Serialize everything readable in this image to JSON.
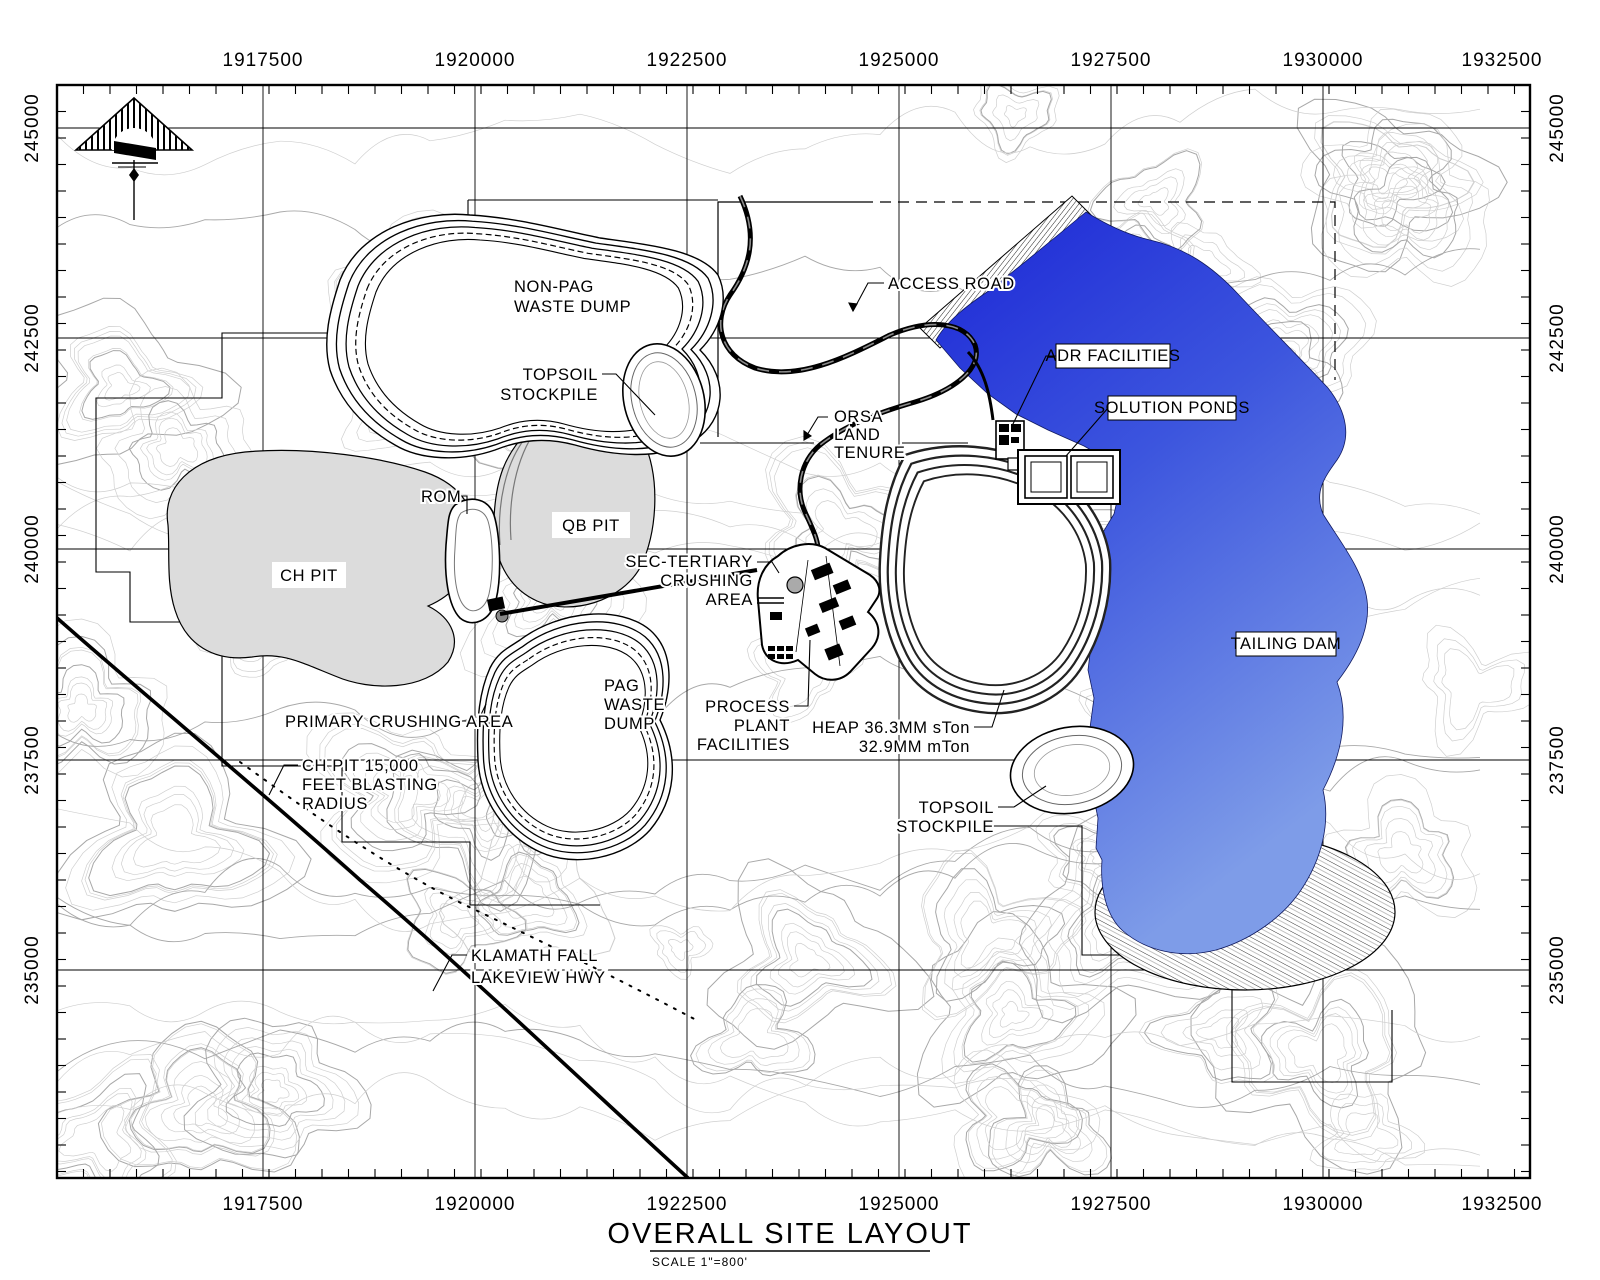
{
  "map": {
    "axis": {
      "x_labels": [
        "1917500",
        "1920000",
        "1922500",
        "1925000",
        "1927500",
        "1930000",
        "1932500"
      ],
      "y_labels": [
        "245000",
        "242500",
        "240000",
        "237500",
        "235000"
      ]
    },
    "labels": {
      "non_pag": {
        "lines": [
          "NON-PAG",
          "WASTE DUMP"
        ]
      },
      "topsoil_upper": {
        "lines": [
          "TOPSOIL",
          "STOCKPILE"
        ]
      },
      "access_road": "ACCESS ROAD",
      "adr": "ADR FACILITIES",
      "solution_ponds": "SOLUTION PONDS",
      "orsa": {
        "lines": [
          "ORSA",
          "LAND",
          "TENURE"
        ]
      },
      "rom": "ROM",
      "qb_pit": "QB PIT",
      "ch_pit": "CH PIT",
      "sec_tertiary": {
        "lines": [
          "SEC-TERTIARY",
          "CRUSHING",
          "AREA"
        ]
      },
      "tailing_dam": "TAILING DAM",
      "pag": {
        "lines": [
          "PAG",
          "WASTE",
          "DUMP"
        ]
      },
      "primary_crushing": "PRIMARY CRUSHING AREA",
      "process_plant": {
        "lines": [
          "PROCESS",
          "PLANT",
          "FACILITIES"
        ]
      },
      "heap": {
        "lines": [
          "HEAP 36.3MM sTon",
          "32.9MM mTon"
        ]
      },
      "blasting": {
        "lines": [
          "CH PIT 15,000",
          "FEET BLASTING",
          "RADIUS"
        ]
      },
      "topsoil_lower": {
        "lines": [
          "TOPSOIL",
          "STOCKPILE"
        ]
      },
      "highway": {
        "lines": [
          "KLAMATH FALL",
          "LAKEVIEW HWY"
        ]
      }
    },
    "title": "OVERALL SITE LAYOUT",
    "scale_note": "SCALE   1\"=800'",
    "colors": {
      "water_dark": "#1c27d6",
      "water_mid": "#3c55de",
      "water_light": "#7e9ce8",
      "pit_fill": "#dcdcdc",
      "contour_minor": "#cfcfcf",
      "contour_major": "#a8a8a8"
    }
  }
}
